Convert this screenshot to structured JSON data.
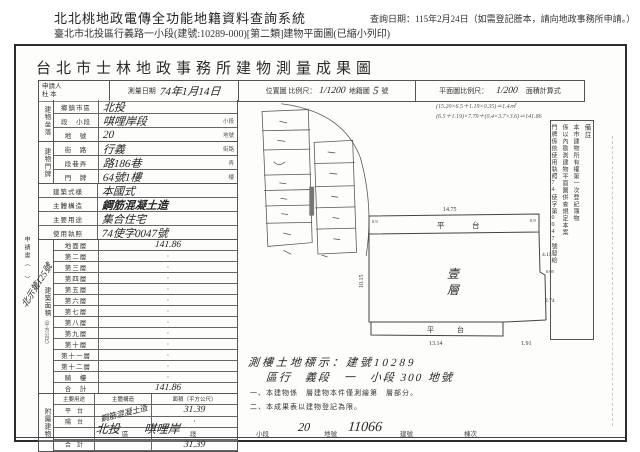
{
  "page": {
    "sys_title": "北北桃地政電傳全功能地籍資料查詢系統",
    "query_date": "查詢日期：115年2月24日（如需登記謄本，請向地政事務所申請。）",
    "subtitle": "臺北市北投區行義路一小段(建號:10289-000)[第二類]建物平面圖(已縮小列印)"
  },
  "doc": {
    "title": "台北市士林地政事務所建物測量成果圖",
    "band": {
      "applicant_label": "申請人",
      "applicant_value": "杜 本",
      "date_label": "測量日期",
      "date_value": "74年1月14日",
      "loc_label": "位置圖 比例尺：",
      "loc_scale": "1/1200",
      "cad_label": "地籍圖",
      "cad_no": "5",
      "cad_unit": "號",
      "plan_label": "平面圖比例尺：",
      "plan_scale": "1/200",
      "calc_label": "面積計算式"
    },
    "calc_lines": [
      "(15.20×6.5＋1.19×0.35)＝1.4㎡",
      "(6.5＋1.19)×7.79＋(0.4×3.7×3.6)＝141.86"
    ],
    "site": {
      "glabel": "建物坐落",
      "rows": [
        {
          "l": "鄉鎮市區",
          "v": "北投",
          "s": ""
        },
        {
          "l": "段　小段",
          "v": "唭哩岸段",
          "s": "小段"
        },
        {
          "l": "地　號",
          "v": "20",
          "s": "地號"
        }
      ]
    },
    "door": {
      "glabel": "建物門牌",
      "rows": [
        {
          "l": "街　路",
          "v": "行義",
          "s": "街路"
        },
        {
          "l": "段巷弄",
          "v": "路186巷",
          "s": "弄"
        },
        {
          "l": "門　牌",
          "v": "64號1樓",
          "s": "樓"
        }
      ]
    },
    "attrs": {
      "rows": [
        {
          "l": "建築式樣",
          "v": "本國式"
        },
        {
          "l": "主體構造",
          "v": "鋼筋混凝土造"
        },
        {
          "l": "主要用途",
          "v": "集合住宅"
        },
        {
          "l": "使用執照",
          "v": "74使字0047號"
        }
      ]
    },
    "area": {
      "glabel": "建築面積",
      "unit": "（平方公尺）",
      "rows": [
        {
          "l": "地面層",
          "v": "141.86"
        },
        {
          "l": "第二層",
          "v": "·"
        },
        {
          "l": "第三層",
          "v": "·"
        },
        {
          "l": "第四層",
          "v": "·"
        },
        {
          "l": "第五層",
          "v": "·"
        },
        {
          "l": "第六層",
          "v": "·"
        },
        {
          "l": "第七層",
          "v": "·"
        },
        {
          "l": "第八層",
          "v": "·"
        },
        {
          "l": "第九層",
          "v": "·"
        },
        {
          "l": "第十層",
          "v": "·"
        },
        {
          "l": "第十一層",
          "v": "·"
        },
        {
          "l": "第十二層",
          "v": "·"
        },
        {
          "l": "騎　樓",
          "v": "·"
        },
        {
          "l": "合　計",
          "v": "141.86"
        }
      ]
    },
    "annex": {
      "glabel": "附屬建物",
      "h1": "主要用途",
      "h2": "主體構造",
      "h3": "面積（平方公尺）",
      "diag": "鋼筋混凝土造",
      "rows": [
        {
          "c1": "平　台",
          "c3": "31.39"
        },
        {
          "c1": "陽　台",
          "c3": "·"
        },
        {
          "c1": "",
          "c3": "·"
        },
        {
          "c1": "合　計",
          "c3": "31.39"
        }
      ]
    },
    "margin": {
      "vlabel": "申請書（　）",
      "note": "北示第125號"
    },
    "plan": {
      "room1": "壹",
      "room2": "層",
      "strip_top": "平　台",
      "strip_bottom": "平　台",
      "dim_top": "14.75",
      "dim_left": "10.15",
      "dim_r1": "4.15",
      "dim_r2": "0.05",
      "dim_r3": "2.74",
      "dim_bottom": "13.14",
      "dim_br": "1.91",
      "corner_l": "0.9",
      "corner_r": "0.9"
    },
    "below": {
      "line1": "測樓土地標示：建號10289",
      "line2": "區行　義段　一　小段 300 地號"
    },
    "notes": [
      "一、本建物係　層建物本件僅測繪第　層部分。",
      "二、本成果表以建物登記為限。"
    ],
    "stamp": {
      "c1": "備註",
      "c2": "本市建物所有權第一次登記簿物",
      "c3": "係以內勘測建物平面圖併查規定本案",
      "c4": "門牌係依使用執照74使字第0047號發給"
    },
    "footer": {
      "v1": "北投",
      "l1": "區",
      "v2": "唭哩岸",
      "l2": "段",
      "l3": "小段",
      "v4": "20",
      "l4": "地號",
      "v5": "11066",
      "l5": "建號",
      "l6": "棟次"
    }
  }
}
